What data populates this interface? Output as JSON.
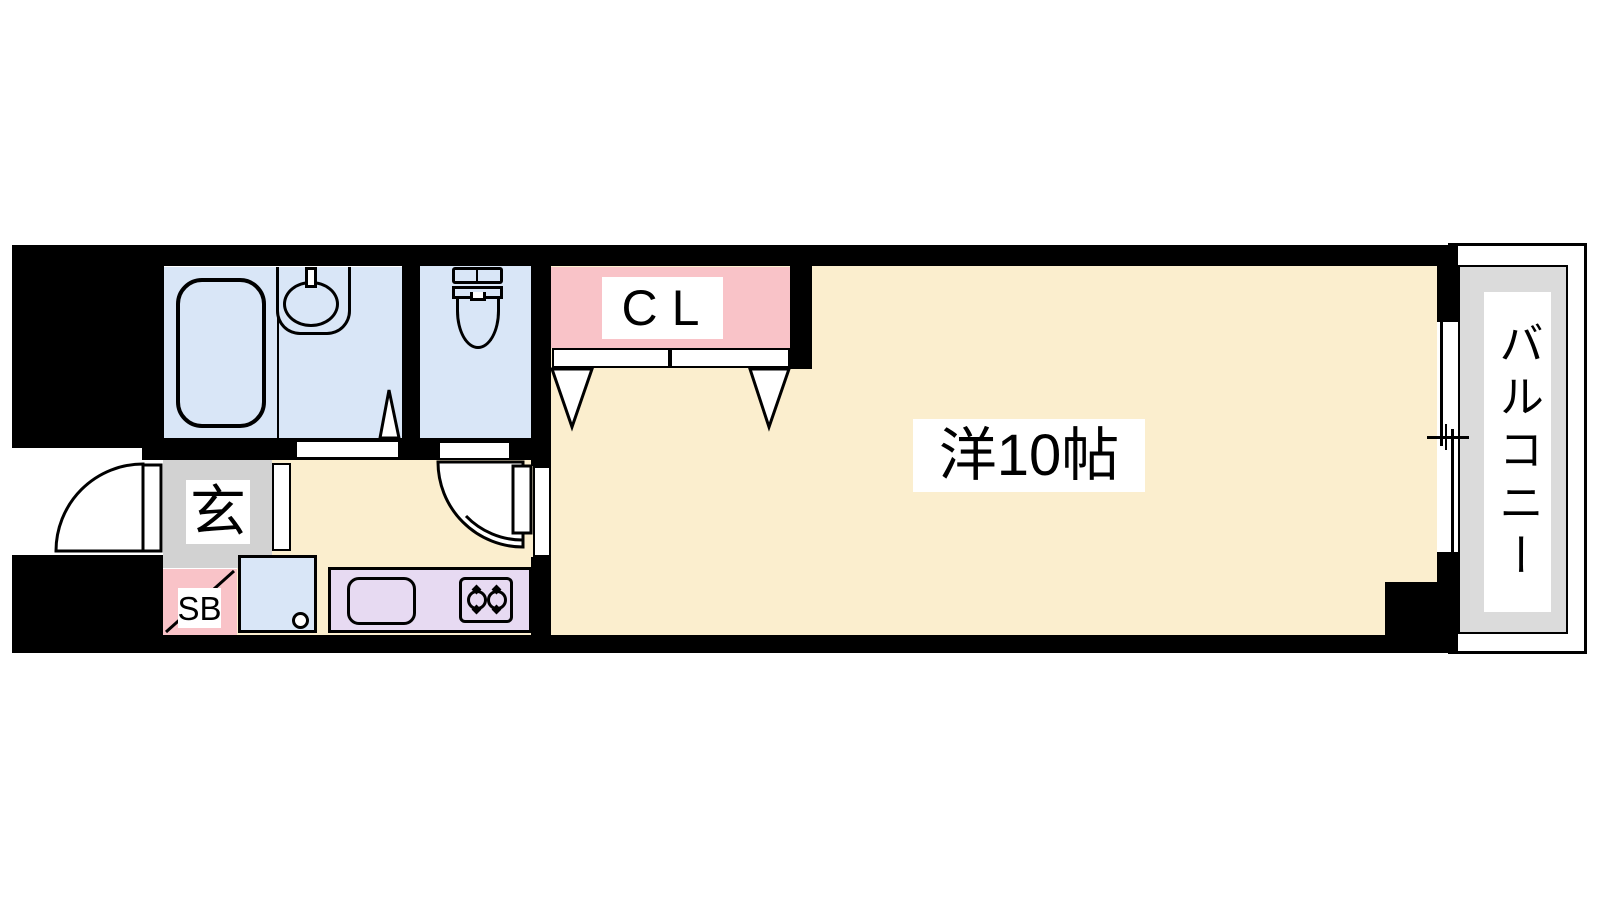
{
  "plan": {
    "title": "apartment-floor-plan",
    "labels": {
      "closet": "CL",
      "entrance": "玄",
      "shoebox": "SB",
      "main_room": "洋10帖",
      "balcony": "バルコニー"
    },
    "rooms": [
      {
        "name": "closet",
        "label": "CL"
      },
      {
        "name": "entrance-hall",
        "label": "玄"
      },
      {
        "name": "shoe-box",
        "label": "SB"
      },
      {
        "name": "western-room-10-mat",
        "label": "洋10帖"
      },
      {
        "name": "balcony",
        "label": "バルコニー"
      }
    ],
    "colors": {
      "wall": "#000000",
      "room_floor": "#FBEECE",
      "wet_area_floor": "#D9E6F7",
      "closet_fill": "#F9C3C8",
      "kitchen_counter": "#E7DAF2",
      "entrance_floor": "#D2D2D2",
      "balcony_floor": "#DBDBDB",
      "label_background": "#FFFFFF"
    }
  }
}
